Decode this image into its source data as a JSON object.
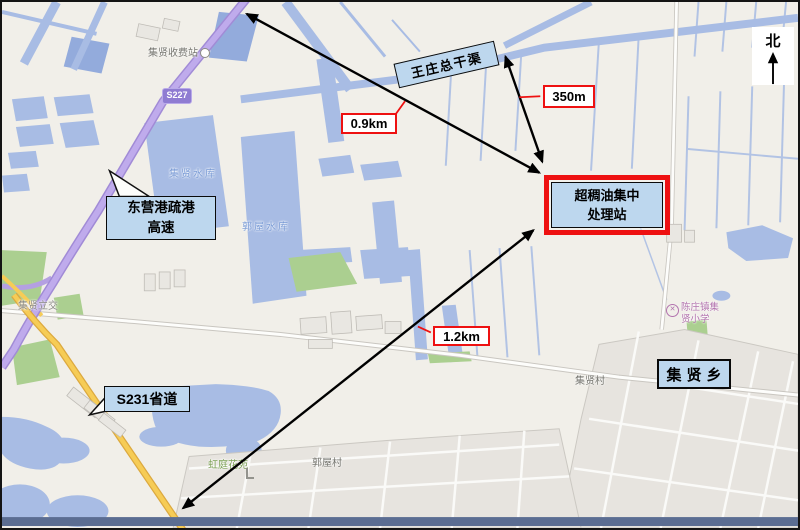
{
  "north_label": "北",
  "annotations": {
    "canal": "王庄总干渠",
    "facility_line1": "超稠油集中",
    "facility_line2": "处理站",
    "expressway_line1": "东营港疏港",
    "expressway_line2": "高速",
    "s231": "S231省道",
    "town": "集贤乡",
    "dist_350": "350m",
    "dist_09": "0.9km",
    "dist_12": "1.2km"
  },
  "map_labels": {
    "toll_station": "集贤收费站",
    "route_shield": "S227",
    "reservoir_jixian": "集贤水库",
    "reservoir_guowu": "郭屋水库",
    "interchange": "集贤立交",
    "garden": "虹庭花苑",
    "village_guowu": "郭屋村",
    "village_jixian": "集贤村",
    "school_line1": "陈庄镇集",
    "school_line2": "贤小学"
  },
  "colors": {
    "water": "#a8bce4",
    "expressway_purple": "#bfabec",
    "provincial_yellow": "#f6cc56",
    "annotation_blue": "#bdd7ee",
    "highlight_red": "#ee1111",
    "greenery": "#abcf90"
  }
}
